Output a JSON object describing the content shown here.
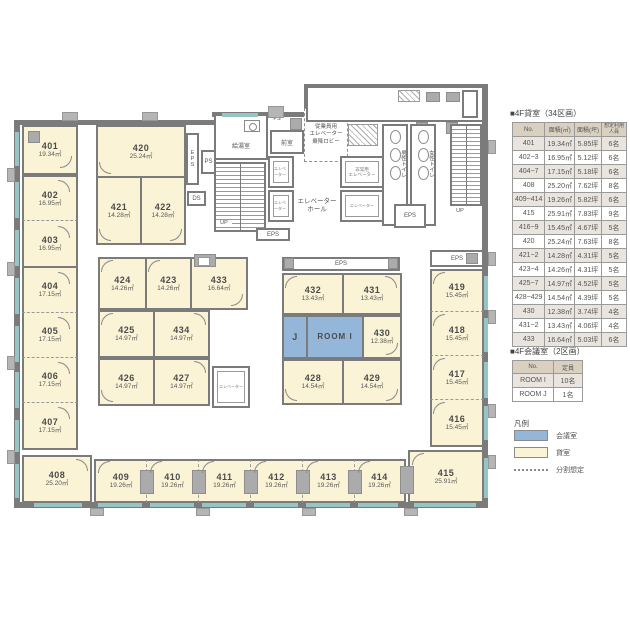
{
  "sidebar": {
    "rent_section_title": "■4F貸室（34区画）",
    "rent_headers": {
      "no": "No.",
      "sqm": "面積(㎡)",
      "tsubo": "面積(坪)",
      "capacity": "想定利用人員"
    },
    "rent_rows": [
      {
        "no": "401",
        "sqm": "19.34㎡",
        "tsubo": "5.85坪",
        "capacity": "6名"
      },
      {
        "no": "402~3",
        "sqm": "16.95㎡",
        "tsubo": "5.12坪",
        "capacity": "6名"
      },
      {
        "no": "404~7",
        "sqm": "17.15㎡",
        "tsubo": "5.18坪",
        "capacity": "6名"
      },
      {
        "no": "408",
        "sqm": "25.20㎡",
        "tsubo": "7.62坪",
        "capacity": "8名"
      },
      {
        "no": "409~414",
        "sqm": "19.26㎡",
        "tsubo": "5.82坪",
        "capacity": "6名"
      },
      {
        "no": "415",
        "sqm": "25.91㎡",
        "tsubo": "7.83坪",
        "capacity": "9名"
      },
      {
        "no": "416~9",
        "sqm": "15.45㎡",
        "tsubo": "4.67坪",
        "capacity": "5名"
      },
      {
        "no": "420",
        "sqm": "25.24㎡",
        "tsubo": "7.63坪",
        "capacity": "8名"
      },
      {
        "no": "421~2",
        "sqm": "14.28㎡",
        "tsubo": "4.31坪",
        "capacity": "5名"
      },
      {
        "no": "423~4",
        "sqm": "14.26㎡",
        "tsubo": "4.31坪",
        "capacity": "5名"
      },
      {
        "no": "425~7",
        "sqm": "14.97㎡",
        "tsubo": "4.52坪",
        "capacity": "5名"
      },
      {
        "no": "428~429",
        "sqm": "14.54㎡",
        "tsubo": "4.39坪",
        "capacity": "5名"
      },
      {
        "no": "430",
        "sqm": "12.38㎡",
        "tsubo": "3.74坪",
        "capacity": "4名"
      },
      {
        "no": "431~2",
        "sqm": "13.43㎡",
        "tsubo": "4.06坪",
        "capacity": "4名"
      },
      {
        "no": "433",
        "sqm": "16.64㎡",
        "tsubo": "5.03坪",
        "capacity": "6名"
      }
    ],
    "meeting_section_title": "■4F会議室（2区画）",
    "meeting_headers": {
      "no": "No.",
      "capacity": "定員"
    },
    "meeting_rows": [
      {
        "no": "ROOM I",
        "capacity": "10名"
      },
      {
        "no": "ROOM J",
        "capacity": "1名"
      }
    ],
    "legend": {
      "title": "凡例",
      "meeting_label": "会議室",
      "rent_label": "貸室",
      "division_label": "分割想定"
    }
  },
  "plan": {
    "rooms": [
      {
        "no": "401",
        "area": "19.34㎡"
      },
      {
        "no": "402",
        "area": "16.95㎡"
      },
      {
        "no": "403",
        "area": "16.95㎡"
      },
      {
        "no": "404",
        "area": "17.15㎡"
      },
      {
        "no": "405",
        "area": "17.15㎡"
      },
      {
        "no": "406",
        "area": "17.15㎡"
      },
      {
        "no": "407",
        "area": "17.15㎡"
      },
      {
        "no": "408",
        "area": "25.20㎡"
      },
      {
        "no": "409",
        "area": "19.26㎡"
      },
      {
        "no": "410",
        "area": "19.26㎡"
      },
      {
        "no": "411",
        "area": "19.26㎡"
      },
      {
        "no": "412",
        "area": "19.26㎡"
      },
      {
        "no": "413",
        "area": "19.26㎡"
      },
      {
        "no": "414",
        "area": "19.26㎡"
      },
      {
        "no": "415",
        "area": "25.91㎡"
      },
      {
        "no": "416",
        "area": "15.45㎡"
      },
      {
        "no": "417",
        "area": "15.45㎡"
      },
      {
        "no": "418",
        "area": "15.45㎡"
      },
      {
        "no": "419",
        "area": "15.45㎡"
      },
      {
        "no": "420",
        "area": "25.24㎡"
      },
      {
        "no": "421",
        "area": "14.28㎡"
      },
      {
        "no": "422",
        "area": "14.28㎡"
      },
      {
        "no": "423",
        "area": "14.26㎡"
      },
      {
        "no": "424",
        "area": "14.26㎡"
      },
      {
        "no": "425",
        "area": "14.97㎡"
      },
      {
        "no": "426",
        "area": "14.97㎡"
      },
      {
        "no": "427",
        "area": "14.97㎡"
      },
      {
        "no": "428",
        "area": "14.54㎡"
      },
      {
        "no": "429",
        "area": "14.54㎡"
      },
      {
        "no": "430",
        "area": "12.38㎡"
      },
      {
        "no": "431",
        "area": "13.43㎡"
      },
      {
        "no": "432",
        "area": "13.43㎡"
      },
      {
        "no": "433",
        "area": "16.64㎡"
      },
      {
        "no": "434",
        "area": "14.97㎡"
      }
    ],
    "core": {
      "kyutoshitsu": "給湯室",
      "zenshitsu": "前室",
      "elevator": "エレベーター",
      "elevator_hall_line1": "エレベーター",
      "elevator_hall_line2": "ホール",
      "emergency_line1": "非常用",
      "emergency_line2": "エレベーター",
      "staff_lobby_line1": "従業員用",
      "staff_lobby_line2": "エレベーター",
      "staff_lobby_line3": "乗降ロビー",
      "mens_toilet": "男性トイレ",
      "womens_toilet": "女性トイレ",
      "eps": "EPS",
      "ps": "PS",
      "ds": "DS",
      "up": "UP",
      "room_i": "ROOM I",
      "room_j": "J"
    },
    "colors": {
      "rent_room": "#faf3d6",
      "meeting_room": "#94b6d8",
      "wall": "#7b7b7b",
      "window": "#97c4c6"
    }
  }
}
